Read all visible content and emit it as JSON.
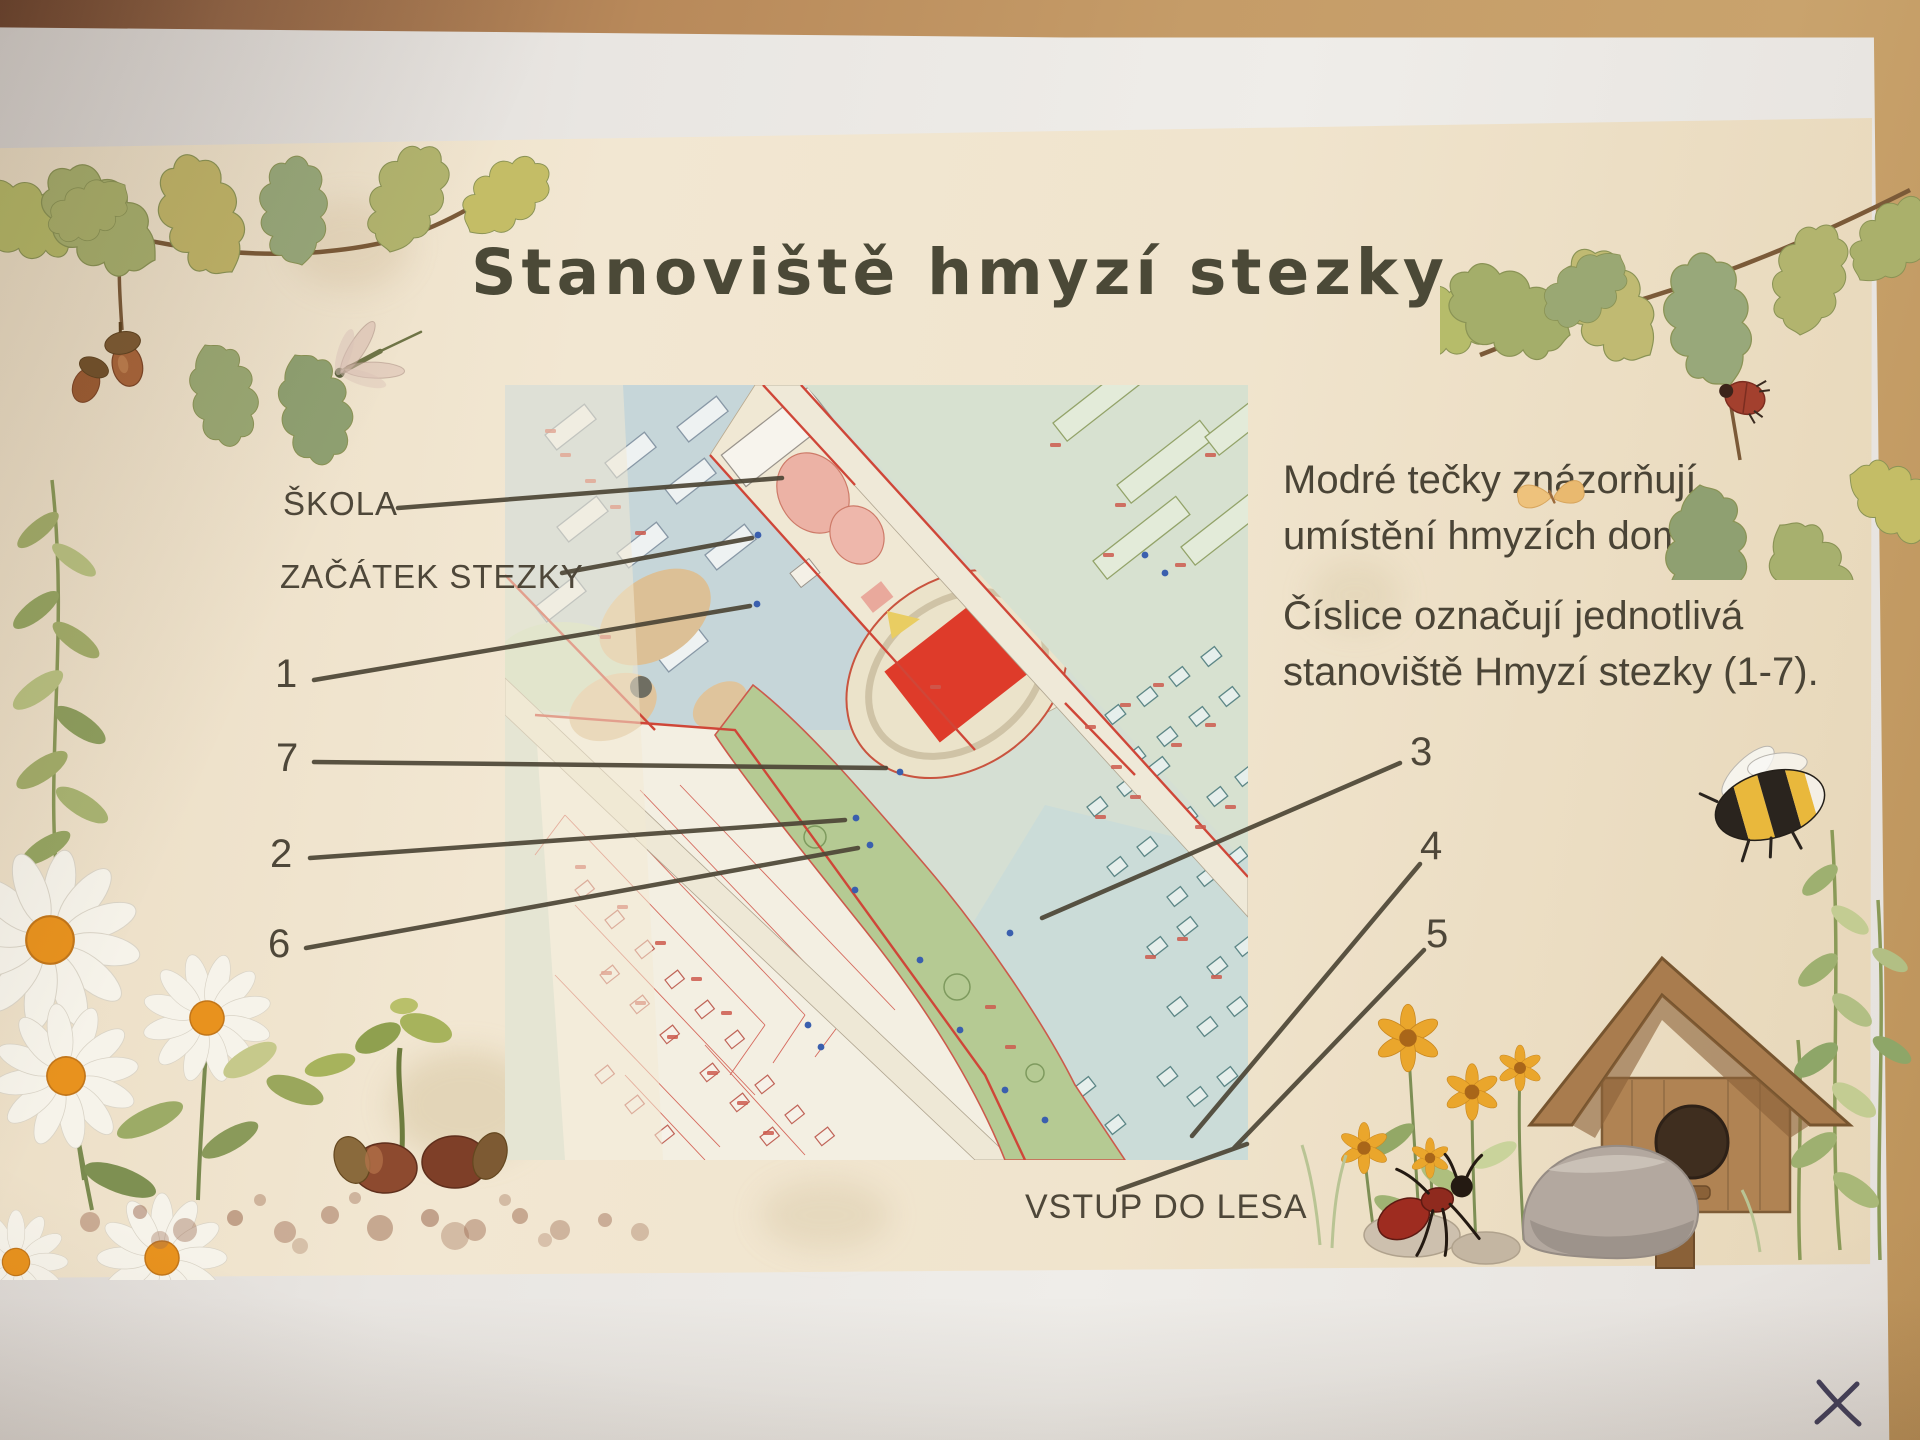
{
  "poster": {
    "title": "Stanoviště hmyzí stezky",
    "info1": {
      "line1": "Modré tečky znázorňují",
      "line2": "umístění hmyzích domků."
    },
    "info2": {
      "line1": "Číslice označují jednotlivá",
      "line2": "stanoviště Hmyzí stezky (1-7)."
    },
    "labels": {
      "skola": "ŠKOLA",
      "zacatek": "ZAČÁTEK STEZKY",
      "n1": "1",
      "n7": "7",
      "n2": "2",
      "n6": "6",
      "n3": "3",
      "n4": "4",
      "n5": "5",
      "vstup": "VSTUP DO LESA"
    },
    "map": {
      "type": "cadastral-town-map",
      "station_count": 7,
      "marker_color": "#3a5fae",
      "field_color": "#de3b2a",
      "boundary_color": "#cf4638"
    },
    "decorations": [
      "oak-branch-with-acorn",
      "dragonfly",
      "oak-branch-with-beetle",
      "butterfly",
      "bumblebee",
      "birdhouse",
      "yellow-flowers",
      "daisies",
      "rock",
      "ant",
      "acorns-with-sprout",
      "soil",
      "greenery-sprigs"
    ],
    "colors": {
      "paper": "#f0e4cd",
      "text": "#4a4436",
      "title": "#4b4937"
    }
  },
  "photo": {
    "pen_mark_symbol": "×",
    "surface": "wooden-table",
    "under_sheet": "white-paper"
  }
}
